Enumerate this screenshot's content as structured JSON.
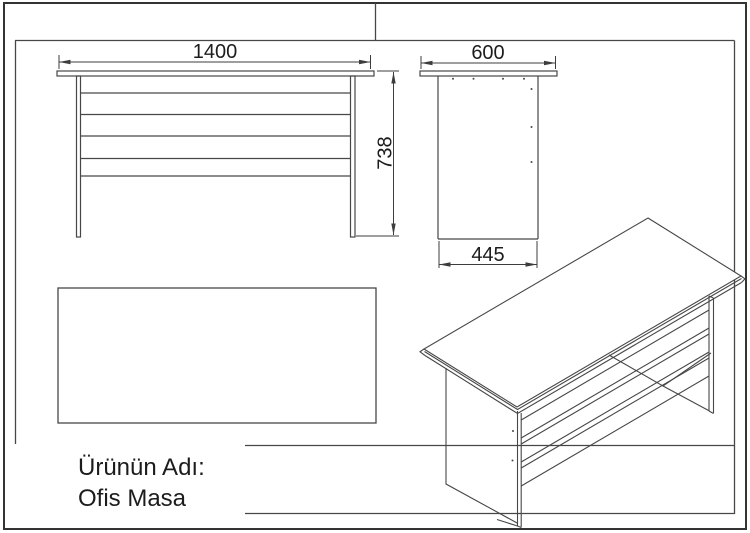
{
  "colors": {
    "line": "#474747",
    "dimension": "#3d3d3d",
    "border": "#333333",
    "text": "#1c1c1c",
    "background": "#ffffff"
  },
  "views": {
    "front": {
      "width_dim": "1400",
      "height_dim": "738"
    },
    "side": {
      "top_depth_dim": "600",
      "panel_depth_dim": "445"
    }
  },
  "title_block": {
    "product_label": "Ürünün Adı:",
    "product_name": "Ofis Masa"
  }
}
